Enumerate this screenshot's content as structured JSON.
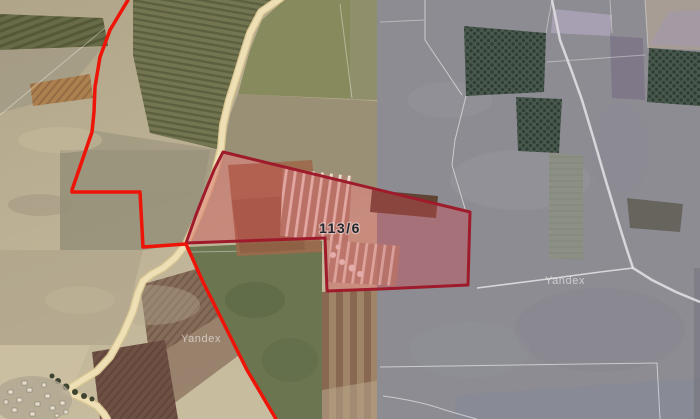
{
  "map_view": {
    "provider": "Yandex",
    "watermarks": [
      {
        "text": "Yandex"
      },
      {
        "text": "Yandex"
      }
    ],
    "parcel": {
      "label": "113/6"
    },
    "colors": {
      "boundary_red": "#ee1408",
      "parcel_stroke": "#9e1b2c",
      "parcel_fill": "rgba(208,70,78,0.38)",
      "road": "#eedfb5",
      "road_edge": "#d9c693",
      "left_terrain": "#b3a78e",
      "right_terrain": "#8e8c93"
    }
  }
}
